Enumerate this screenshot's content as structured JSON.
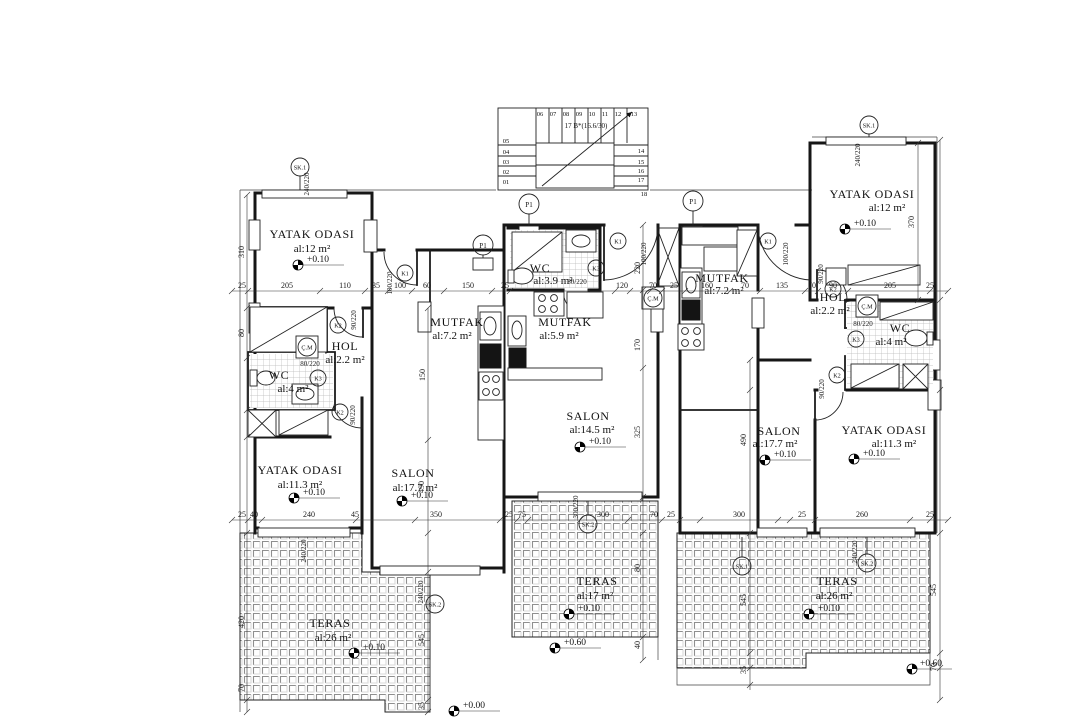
{
  "rooms": [
    {
      "name": "YATAK ODASI",
      "area": "al:12 m²"
    },
    {
      "name": "HOL",
      "area": "al:2.2 m²"
    },
    {
      "name": "WC",
      "area": "al:4 m²"
    },
    {
      "name": "YATAK ODASI",
      "area": "al:11.3 m²"
    },
    {
      "name": "SALON",
      "area": "al:17.7 m²"
    },
    {
      "name": "MUTFAK",
      "area": "al:7.2 m²"
    },
    {
      "name": "TERAS",
      "area": "al:26 m²"
    },
    {
      "name": "WC",
      "area": "al:3.9 m²"
    },
    {
      "name": "MUTFAK",
      "area": "al:5.9 m²"
    },
    {
      "name": "SALON",
      "area": "al:14.5 m²"
    },
    {
      "name": "TERAS",
      "area": "al:17 m²"
    },
    {
      "name": "MUTFAK",
      "area": "al:7.2 m²"
    },
    {
      "name": "HOL",
      "area": "al:2.2 m²"
    },
    {
      "name": "WC",
      "area": "al:4 m²"
    },
    {
      "name": "YATAK ODASI",
      "area": "al:12 m²"
    },
    {
      "name": "SALON",
      "area": "al:17.7 m²"
    },
    {
      "name": "YATAK ODASI",
      "area": "al:11.3 m²"
    },
    {
      "name": "TERAS",
      "area": "al:26 m²"
    }
  ],
  "levels": {
    "p10": "+0.10",
    "p60": "+0.60",
    "p00": "+0.00"
  },
  "stair": {
    "note": "17 B*(16.6/30)",
    "top": [
      "06",
      "07",
      "08",
      "09",
      "10",
      "11",
      "12",
      "13"
    ],
    "left": [
      "05",
      "04",
      "03",
      "02",
      "01"
    ],
    "right": [
      "14",
      "15",
      "16",
      "17",
      "18"
    ]
  },
  "marks": {
    "p1": "P1",
    "k1": "K1",
    "k2": "K2",
    "k3": "K3",
    "sk1": "SK.1",
    "sk2": "SK.2",
    "cm": "Ç.M"
  },
  "openings": {
    "d80": "80/220",
    "d90": "90/220",
    "d100": "100/220",
    "w240": "240/220",
    "w300": "300/220"
  },
  "dims": {
    "hmid": [
      "25",
      "205",
      "110",
      "35",
      "100",
      "60",
      "150",
      "25",
      "120",
      "70",
      "25",
      "160",
      "70",
      "135",
      "70",
      "90",
      "205",
      "25"
    ],
    "hbot": [
      "25",
      "40",
      "240",
      "45",
      "350",
      "25",
      "75",
      "300",
      "70",
      "25",
      "300",
      "25",
      "260",
      "25"
    ],
    "vert": [
      "310",
      "80",
      "420",
      "70",
      "150",
      "490",
      "545",
      "220",
      "170",
      "325",
      "80",
      "40",
      "370",
      "545",
      "70",
      "490",
      "545",
      "35",
      "35"
    ]
  }
}
